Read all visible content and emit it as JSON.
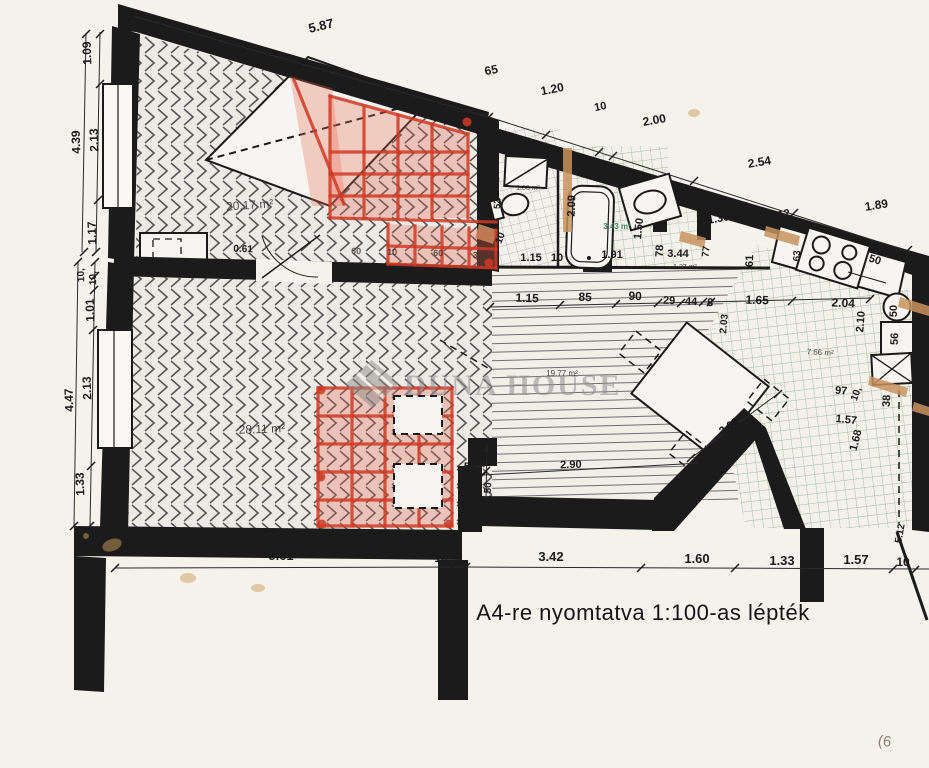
{
  "document": {
    "scale_note": "A4-re nyomtatva 1:100-as lépték",
    "watermark": {
      "text": "DUNA HOUSE",
      "logo": "duna-house-diamond-logo"
    }
  },
  "colors": {
    "paper": "#f5f2ec",
    "wall": "#1b1b1b",
    "red": "#cf3a24",
    "red-fill": "rgba(228,104,80,0.30)",
    "beige": "#c8935f",
    "tile-green": "#6f9c6f",
    "gray": "#8d8d8d",
    "stain": "#c9a05e"
  },
  "rooms": [
    {
      "name": "room-upper-left",
      "area": "20.17 m²"
    },
    {
      "name": "room-lower-left",
      "area": "28.11 m²"
    },
    {
      "name": "dining-living",
      "area": "19.77 m²"
    },
    {
      "name": "kitchen",
      "area": "7.66 m²"
    },
    {
      "name": "bathroom",
      "area": "3.43 m²"
    },
    {
      "name": "wc",
      "area": "1.66 m²"
    },
    {
      "name": "closet",
      "area": "1.27 m²"
    }
  ],
  "labels": {
    "top_chain": [
      {
        "t": "5.87",
        "x": 322,
        "y": 30,
        "r": -13,
        "s": 13
      },
      {
        "t": "65",
        "x": 492,
        "y": 74,
        "r": -11,
        "s": 12
      },
      {
        "t": "1.20",
        "x": 553,
        "y": 93,
        "r": -11,
        "s": 12
      },
      {
        "t": "10",
        "x": 601,
        "y": 110,
        "r": -11,
        "s": 11
      },
      {
        "t": "2.00",
        "x": 655,
        "y": 124,
        "r": -10,
        "s": 12
      },
      {
        "t": "2.54",
        "x": 760,
        "y": 166,
        "r": -9,
        "s": 12
      },
      {
        "t": "1.89",
        "x": 877,
        "y": 209,
        "r": -9,
        "s": 12
      },
      {
        "t": "1.36",
        "x": 719,
        "y": 222,
        "r": -10,
        "s": 11
      },
      {
        "t": "1.12",
        "x": 780,
        "y": 218,
        "r": -10,
        "s": 11
      }
    ],
    "left_chain": [
      {
        "t": "1.09",
        "x": 91,
        "y": 53,
        "r": -92,
        "s": 12
      },
      {
        "t": "4.39",
        "x": 80,
        "y": 142,
        "r": -92,
        "s": 12
      },
      {
        "t": "2.13",
        "x": 98,
        "y": 140,
        "r": -92,
        "s": 12
      },
      {
        "t": "1.17",
        "x": 96,
        "y": 233,
        "r": -92,
        "s": 12
      },
      {
        "t": "10,",
        "x": 84,
        "y": 275,
        "r": -92,
        "s": 10
      },
      {
        "t": "10,",
        "x": 96,
        "y": 278,
        "r": -92,
        "s": 10
      },
      {
        "t": "1.01",
        "x": 94,
        "y": 310,
        "r": -92,
        "s": 12
      },
      {
        "t": "2.13",
        "x": 91,
        "y": 388,
        "r": -92,
        "s": 12
      },
      {
        "t": "4.47",
        "x": 73,
        "y": 400,
        "r": -92,
        "s": 12
      },
      {
        "t": "1.33",
        "x": 84,
        "y": 484,
        "r": -92,
        "s": 12
      }
    ],
    "bottom_chain": [
      {
        "t": "5.61",
        "x": 281,
        "y": 560,
        "s": 13
      },
      {
        "t": "10",
        "x": 441,
        "y": 562,
        "s": 12
      },
      {
        "t": "3.42",
        "x": 551,
        "y": 561,
        "s": 13
      },
      {
        "t": "1.60",
        "x": 697,
        "y": 563,
        "s": 13
      },
      {
        "t": "1.33",
        "x": 782,
        "y": 565,
        "s": 13
      },
      {
        "t": "1.57",
        "x": 856,
        "y": 564,
        "s": 13
      },
      {
        "t": "10",
        "x": 903,
        "y": 566,
        "s": 12
      }
    ],
    "middle_chain": [
      {
        "t": "1.15",
        "x": 527,
        "y": 302,
        "r": 2,
        "s": 12
      },
      {
        "t": "85",
        "x": 585,
        "y": 301,
        "r": 2,
        "s": 12
      },
      {
        "t": "90",
        "x": 635,
        "y": 300,
        "r": 2,
        "s": 12
      },
      {
        "t": "29",
        "x": 669,
        "y": 304,
        "r": 2,
        "s": 11
      },
      {
        "t": "44",
        "x": 691,
        "y": 305,
        "r": 2,
        "s": 11
      },
      {
        "t": "8",
        "x": 710,
        "y": 306,
        "r": 2,
        "s": 11
      },
      {
        "t": "1.65",
        "x": 757,
        "y": 304,
        "r": 2,
        "s": 12
      },
      {
        "t": "2.04",
        "x": 843,
        "y": 307,
        "r": 3,
        "s": 12
      }
    ],
    "rooms": [
      {
        "t": "20.17 m²",
        "x": 250,
        "y": 209,
        "r": -4,
        "s": 12,
        "w": 400,
        "o": 0.75
      },
      {
        "t": "28.11 m²",
        "x": 262,
        "y": 433,
        "r": -2,
        "s": 12,
        "w": 400,
        "o": 0.8
      },
      {
        "t": "19.77 m²",
        "x": 562,
        "y": 376,
        "s": 8,
        "w": 400,
        "o": 0.8
      },
      {
        "t": "7.66 m²",
        "x": 820,
        "y": 355,
        "r": 3,
        "s": 8,
        "w": 400,
        "o": 0.8
      },
      {
        "t": "3.43 m²",
        "x": 617,
        "y": 229,
        "s": 8,
        "w": 600,
        "c": "#2e7d4f",
        "o": 0.9
      },
      {
        "t": "1.66 m²",
        "x": 528,
        "y": 190,
        "s": 7,
        "w": 400,
        "o": 0.7
      },
      {
        "t": "1.27 m²",
        "x": 685,
        "y": 269,
        "s": 7,
        "w": 400,
        "o": 0.8
      }
    ],
    "fixture_dims": [
      {
        "t": "1.15",
        "x": 531,
        "y": 261,
        "s": 11
      },
      {
        "t": "10",
        "x": 557,
        "y": 261,
        "s": 11
      },
      {
        "t": "1.91",
        "x": 612,
        "y": 258,
        "s": 11
      },
      {
        "t": "2.09",
        "x": 575,
        "y": 206,
        "r": -88,
        "s": 11
      },
      {
        "t": "1.50",
        "x": 642,
        "y": 229,
        "r": -84,
        "s": 11
      },
      {
        "t": "78",
        "x": 663,
        "y": 251,
        "r": -88,
        "s": 11
      },
      {
        "t": "3.44",
        "x": 678,
        "y": 257,
        "s": 11
      },
      {
        "t": "77",
        "x": 709,
        "y": 252,
        "r": -83,
        "s": 10
      },
      {
        "t": "61",
        "x": 753,
        "y": 261,
        "r": -88,
        "s": 11
      },
      {
        "t": "63",
        "x": 800,
        "y": 256,
        "r": -88,
        "s": 10
      },
      {
        "t": "50",
        "x": 874,
        "y": 263,
        "r": 17,
        "s": 11
      },
      {
        "t": "50",
        "x": 897,
        "y": 311,
        "r": -90,
        "s": 11
      },
      {
        "t": "56",
        "x": 898,
        "y": 339,
        "r": -88,
        "s": 11
      },
      {
        "t": "2.10",
        "x": 864,
        "y": 322,
        "r": -85,
        "s": 11
      },
      {
        "t": "2.03",
        "x": 727,
        "y": 324,
        "r": -85,
        "s": 10
      },
      {
        "t": "97",
        "x": 841,
        "y": 394,
        "r": 4,
        "s": 11
      },
      {
        "t": "10,",
        "x": 859,
        "y": 395,
        "r": -70,
        "s": 10
      },
      {
        "t": "38",
        "x": 890,
        "y": 401,
        "r": -88,
        "s": 11
      },
      {
        "t": "1.57",
        "x": 846,
        "y": 423,
        "r": 6,
        "s": 11
      },
      {
        "t": "1.68",
        "x": 859,
        "y": 441,
        "r": -76,
        "s": 11
      },
      {
        "t": "2.03",
        "x": 731,
        "y": 429,
        "r": -34,
        "s": 11
      },
      {
        "t": "2.90",
        "x": 571,
        "y": 468,
        "r": -2,
        "s": 11
      },
      {
        "t": "52",
        "x": 470,
        "y": 470,
        "s": 11
      },
      {
        "t": "50",
        "x": 489,
        "y": 458,
        "r": -88,
        "s": 10
      },
      {
        "t": "50",
        "x": 491,
        "y": 488,
        "r": -88,
        "s": 10
      },
      {
        "t": "10",
        "x": 503,
        "y": 239,
        "r": -70,
        "s": 10
      },
      {
        "t": "52",
        "x": 500,
        "y": 204,
        "r": -88,
        "s": 9
      },
      {
        "t": "0.61",
        "x": 243,
        "y": 252,
        "r": 2,
        "s": 10
      },
      {
        "t": "5.12",
        "x": 903,
        "y": 534,
        "r": -80,
        "s": 10
      }
    ],
    "stairs_small": [
      {
        "t": "60",
        "x": 356,
        "y": 254,
        "r": 3,
        "s": 9,
        "o": 0.75,
        "c": "#3a2a22"
      },
      {
        "t": "10",
        "x": 392,
        "y": 255,
        "r": 3,
        "s": 9,
        "o": 0.75,
        "c": "#3a2a22"
      },
      {
        "t": "60",
        "x": 438,
        "y": 256,
        "r": 3,
        "s": 9,
        "o": 0.75,
        "c": "#3a2a22"
      },
      {
        "t": "3",
        "x": 475,
        "y": 258,
        "r": 3,
        "s": 9,
        "o": 0.75,
        "c": "#3a2a22"
      }
    ],
    "misc": [
      {
        "t": "(6",
        "x": 884,
        "y": 746,
        "r": 8,
        "s": 15,
        "w": 400,
        "c": "#8a7f72"
      }
    ]
  }
}
